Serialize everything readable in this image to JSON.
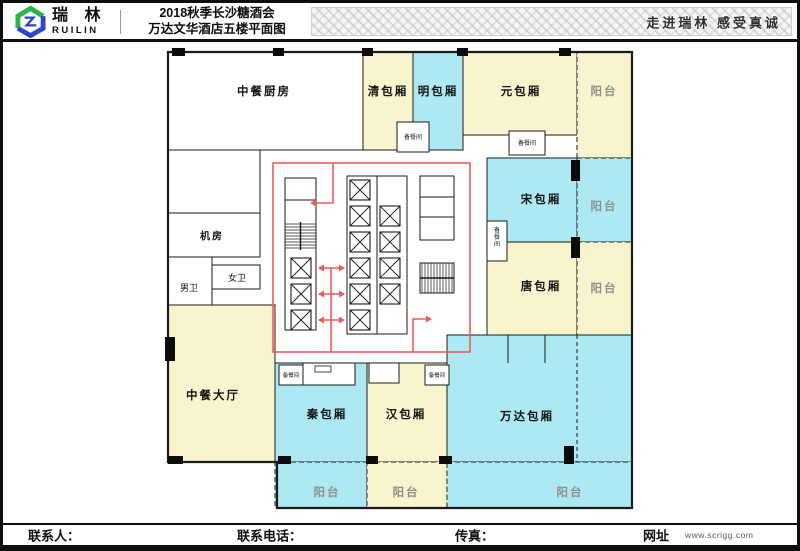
{
  "header": {
    "logo_cn": "瑞 林",
    "logo_en": "RUILIN",
    "title_line1": "2018秋季长沙糖酒会",
    "title_line2": "万达文华酒店五楼平面图",
    "slogan": "走进瑞林   感受真诚"
  },
  "footer": {
    "contact_label": "联系人：",
    "phone_label": "联系电话：",
    "fax_label": "传真：",
    "web_label": "网址",
    "web_url": "www.scrigg.com"
  },
  "colors": {
    "room_yellow": "#F8F4CD",
    "room_cyan": "#ACE9F3",
    "room_white": "#FFFFFF",
    "wall": "#1b1b1b",
    "route_red": "#F25A5A",
    "label_dark": "#141414",
    "label_gray": "#8f8f8f",
    "logo_green": "#2FB14C",
    "logo_blue": "#2B47C5"
  },
  "floorplan": {
    "outline": "M168,52 H632 V508 H277 V462 H168 Z",
    "rooms": [
      {
        "name": "room-kitchen",
        "label": "中餐厨房",
        "fill": "white",
        "x": 168,
        "y": 52,
        "w": 195,
        "h": 98,
        "lx": 264,
        "ly": 92
      },
      {
        "name": "room-kitchen-lower",
        "label": "",
        "fill": "white",
        "x": 168,
        "y": 150,
        "w": 92,
        "h": 63
      },
      {
        "name": "room-qing",
        "label": "清包厢",
        "fill": "yellow",
        "x": 363,
        "y": 52,
        "w": 50,
        "h": 98,
        "lx": 388,
        "ly": 92
      },
      {
        "name": "room-ming",
        "label": "明包厢",
        "fill": "cyan",
        "x": 413,
        "y": 52,
        "w": 50,
        "h": 98,
        "lx": 438,
        "ly": 92
      },
      {
        "name": "room-yuan",
        "label": "元包厢",
        "fill": "yellow",
        "x": 463,
        "y": 52,
        "w": 114,
        "h": 83,
        "lx": 521,
        "ly": 92
      },
      {
        "name": "balcony-top-right",
        "label": "阳台",
        "fill": "yellow",
        "x": 577,
        "y": 52,
        "w": 55,
        "h": 106,
        "lx": 604,
        "ly": 92,
        "gray": true,
        "dashed": true
      },
      {
        "name": "room-song",
        "label": "宋包厢",
        "fill": "cyan",
        "x": 487,
        "y": 158,
        "w": 90,
        "h": 84,
        "lx": 541,
        "ly": 200
      },
      {
        "name": "balcony-song",
        "label": "阳台",
        "fill": "cyan",
        "x": 577,
        "y": 158,
        "w": 55,
        "h": 84,
        "lx": 604,
        "ly": 207,
        "gray": true,
        "dashed": true
      },
      {
        "name": "room-tang",
        "label": "唐包厢",
        "fill": "yellow",
        "x": 487,
        "y": 242,
        "w": 90,
        "h": 93,
        "lx": 541,
        "ly": 287
      },
      {
        "name": "balcony-tang",
        "label": "阳台",
        "fill": "yellow",
        "x": 577,
        "y": 242,
        "w": 55,
        "h": 93,
        "lx": 604,
        "ly": 289,
        "gray": true,
        "dashed": true
      },
      {
        "name": "room-wanda",
        "label": "万达包厢",
        "fill": "cyan",
        "x": 447,
        "y": 335,
        "w": 185,
        "h": 127,
        "lx": 527,
        "ly": 417
      },
      {
        "name": "room-jifang",
        "label": "机房",
        "fill": "white",
        "x": 168,
        "y": 213,
        "w": 92,
        "h": 44,
        "lx": 212,
        "ly": 237,
        "fs": 10
      },
      {
        "name": "room-nanwei",
        "label": "男卫",
        "fill": "white",
        "x": 168,
        "y": 257,
        "w": 44,
        "h": 48,
        "lx": 189,
        "ly": 288,
        "fs": 9
      },
      {
        "name": "room-nuwei",
        "label": "女卫",
        "fill": "white",
        "x": 212,
        "y": 265,
        "w": 48,
        "h": 24,
        "lx": 237,
        "ly": 278,
        "fs": 9
      },
      {
        "name": "room-hall",
        "label": "中餐大厅",
        "fill": "yellow",
        "x": 168,
        "y": 305,
        "w": 107,
        "h": 157,
        "lx": 213,
        "ly": 396
      },
      {
        "name": "room-qin",
        "label": "秦包厢",
        "fill": "cyan",
        "x": 275,
        "y": 363,
        "w": 92,
        "h": 99,
        "lx": 327,
        "ly": 415
      },
      {
        "name": "room-han",
        "label": "汉包厢",
        "fill": "yellow",
        "x": 367,
        "y": 363,
        "w": 80,
        "h": 99,
        "lx": 406,
        "ly": 415
      },
      {
        "name": "balcony-qin",
        "label": "阳台",
        "fill": "cyan",
        "x": 275,
        "y": 462,
        "w": 92,
        "h": 46,
        "lx": 327,
        "ly": 493,
        "gray": true,
        "dashed": true
      },
      {
        "name": "balcony-han",
        "label": "阳台",
        "fill": "yellow",
        "x": 367,
        "y": 462,
        "w": 80,
        "h": 46,
        "lx": 406,
        "ly": 493,
        "gray": true,
        "dashed": true
      },
      {
        "name": "balcony-wanda",
        "label": "阳台",
        "fill": "cyan",
        "x": 447,
        "y": 462,
        "w": 185,
        "h": 46,
        "lx": 570,
        "ly": 493,
        "gray": true,
        "dashed": true
      },
      {
        "name": "room-service-nook-1",
        "label": "",
        "fill": "white",
        "x": 303,
        "y": 363,
        "w": 52,
        "h": 22
      },
      {
        "name": "room-service-nook-2",
        "label": "",
        "fill": "white",
        "x": 369,
        "y": 363,
        "w": 30,
        "h": 20
      },
      {
        "name": "room-prep-1",
        "label": "备餐间",
        "fill": "white",
        "x": 397,
        "y": 122,
        "w": 32,
        "h": 30,
        "lx": 413,
        "ly": 138,
        "fs": 6
      },
      {
        "name": "room-prep-2",
        "label": "备餐间",
        "fill": "white",
        "x": 509,
        "y": 131,
        "w": 36,
        "h": 24,
        "lx": 527,
        "ly": 144,
        "fs": 6
      },
      {
        "name": "room-prep-3",
        "label": "备餐间",
        "fill": "white",
        "x": 487,
        "y": 221,
        "w": 20,
        "h": 40,
        "lx": 497,
        "ly": 231,
        "fs": 6,
        "vertical": true
      },
      {
        "name": "room-prep-4",
        "label": "备餐间",
        "fill": "white",
        "x": 279,
        "y": 365,
        "w": 24,
        "h": 20,
        "lx": 291,
        "ly": 376,
        "fs": 5.5
      },
      {
        "name": "room-prep-5",
        "label": "备餐间",
        "fill": "white",
        "x": 425,
        "y": 365,
        "w": 24,
        "h": 20,
        "lx": 437,
        "ly": 376,
        "fs": 5.5
      }
    ],
    "extra_rects": [
      {
        "x": 315,
        "y": 366,
        "w": 16,
        "h": 6
      }
    ],
    "partition_lines": [
      [
        508,
        335,
        508,
        363
      ],
      [
        545,
        335,
        545,
        363
      ],
      [
        577,
        335,
        577,
        462
      ]
    ],
    "core": {
      "red_rect": {
        "x": 273,
        "y": 163,
        "w": 197,
        "h": 189
      },
      "boxes": [
        {
          "x": 285,
          "y": 178,
          "w": 31,
          "h": 152
        },
        {
          "x": 347,
          "y": 176,
          "w": 60,
          "h": 158
        },
        {
          "x": 420,
          "y": 176,
          "w": 34,
          "h": 64
        },
        {
          "x": 420,
          "y": 263,
          "w": 34,
          "h": 30
        }
      ],
      "lines": [
        [
          285,
          200,
          316,
          200
        ],
        [
          377,
          176,
          377,
          334
        ],
        [
          420,
          197,
          454,
          197
        ],
        [
          420,
          217,
          454,
          217
        ]
      ],
      "stairs": [
        {
          "x": 285,
          "y": 222,
          "w": 31,
          "h": 28,
          "dir": "h"
        },
        {
          "x": 420,
          "y": 263,
          "w": 34,
          "h": 30,
          "dir": "v"
        }
      ],
      "elevator_size": 20,
      "elevators": [
        [
          291,
          258
        ],
        [
          291,
          284
        ],
        [
          291,
          310
        ],
        [
          350,
          180
        ],
        [
          350,
          206
        ],
        [
          350,
          232
        ],
        [
          350,
          258
        ],
        [
          350,
          284
        ],
        [
          350,
          310
        ],
        [
          380,
          206
        ],
        [
          380,
          232
        ],
        [
          380,
          258
        ],
        [
          380,
          284
        ]
      ],
      "route_lines": [
        "M333,163 L333,203 L312,203",
        "M331,268 L331,352",
        "M319,268 L344,268",
        "M319,294 L344,294",
        "M319,320 L344,320",
        "M413,352 L413,319 L430,319"
      ],
      "arrows": [
        {
          "x": 310,
          "y": 203,
          "dir": "left"
        },
        {
          "x": 318,
          "y": 268,
          "dir": "left"
        },
        {
          "x": 345,
          "y": 268,
          "dir": "right"
        },
        {
          "x": 318,
          "y": 294,
          "dir": "left"
        },
        {
          "x": 345,
          "y": 294,
          "dir": "right"
        },
        {
          "x": 318,
          "y": 320,
          "dir": "left"
        },
        {
          "x": 345,
          "y": 320,
          "dir": "right"
        },
        {
          "x": 432,
          "y": 319,
          "dir": "right"
        }
      ]
    },
    "black_markers": [
      [
        172,
        48,
        13,
        8
      ],
      [
        273,
        48,
        11,
        8
      ],
      [
        362,
        48,
        11,
        8
      ],
      [
        457,
        48,
        11,
        8
      ],
      [
        559,
        48,
        12,
        8
      ],
      [
        165,
        337,
        10,
        24
      ],
      [
        571,
        160,
        9,
        21
      ],
      [
        571,
        237,
        9,
        21
      ],
      [
        168,
        456,
        15,
        8
      ],
      [
        278,
        456,
        13,
        8
      ],
      [
        366,
        456,
        12,
        8
      ],
      [
        439,
        456,
        13,
        8
      ],
      [
        564,
        446,
        10,
        18
      ]
    ]
  }
}
